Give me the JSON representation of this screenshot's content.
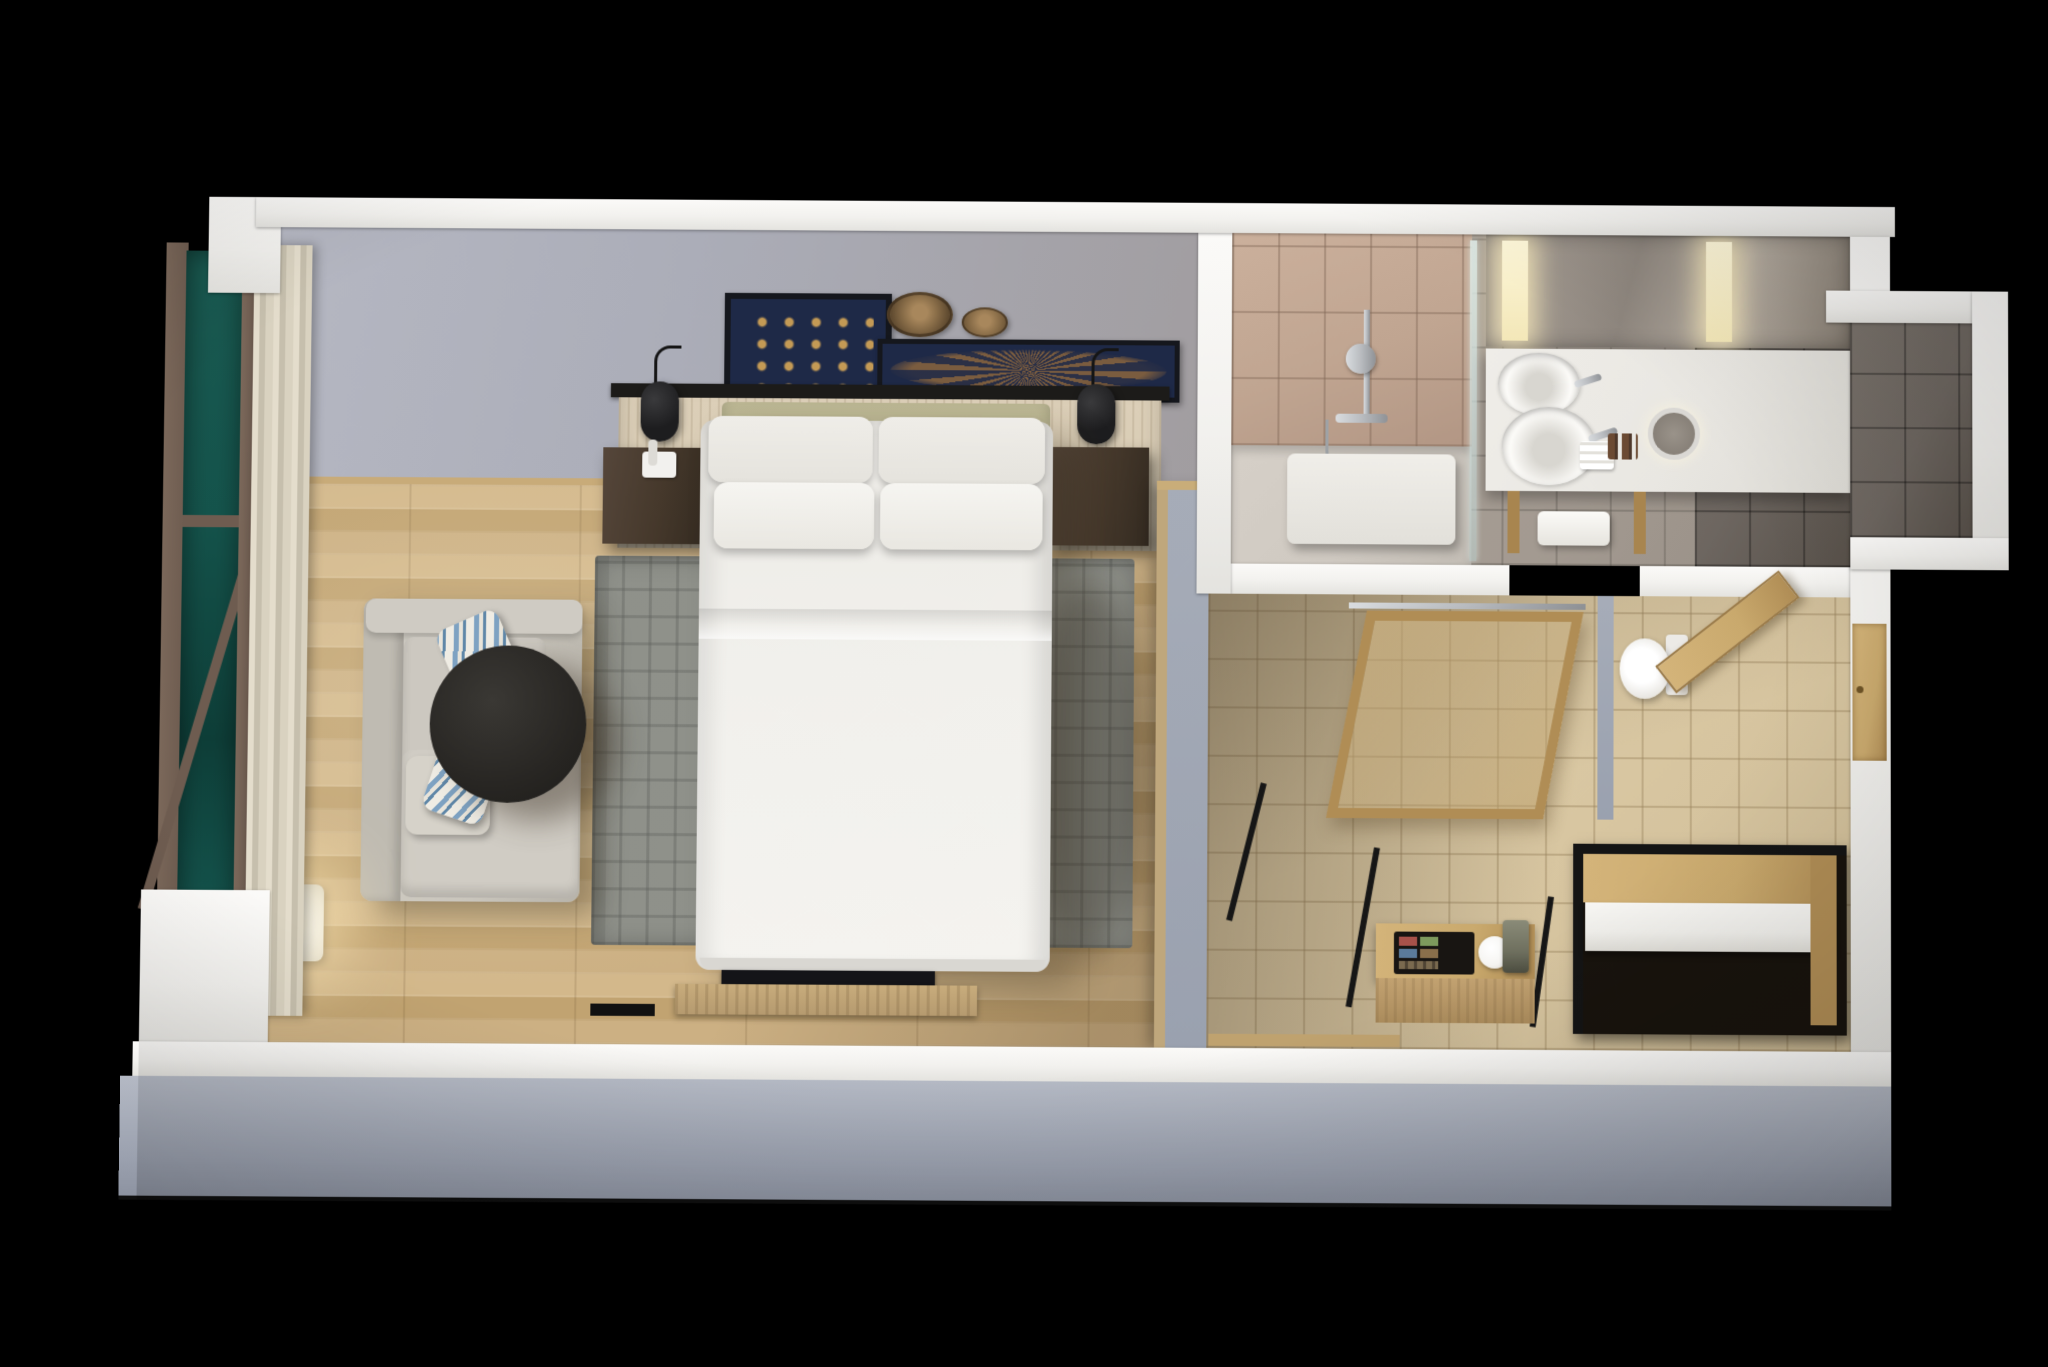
{
  "scene": {
    "type": "3d-floor-plan-render",
    "subject": "hotel-guest-room-studio",
    "view": "isometric-top-down-cutaway",
    "visible_text": []
  },
  "palette": {
    "bg": "#000000",
    "wall": "#f2f1ee",
    "wall-face": "#9aa1af",
    "interior-wall": "#abadb8",
    "wood-a": "#ccb083",
    "wood-b": "#c1a371",
    "rug": "#8b8d86",
    "linen": "#f1f0ec",
    "linen-dim": "#e5e3dd",
    "hb-wood": "#d5c9b1",
    "hb-olive": "#b2ad88",
    "rail": "#1c1b19",
    "nightstand": "#45382b",
    "navy": "#1e2947",
    "gold": "#c49a55",
    "frame-dark": "#15171d",
    "basket": "#8a6e49",
    "sofa": "#c9c5bc",
    "stripe": "#7ea2c2",
    "table": "#282623",
    "curtain": "#d9d2c0",
    "window-teal": "#15544c",
    "window-frame": "#6e5c50",
    "tile-shower": "#c0a591",
    "tile-bath": "#a39a91",
    "tile-dark": "#6d6660",
    "tile-entry": "#d8c6a1",
    "counter": "#e9e7e2",
    "chrome": "#b9bcc0",
    "door-wood": "#c9a96d",
    "closet-frame": "#141414",
    "shelf": "#efeeea",
    "machine": "#6e6f5e",
    "tray": "#181512",
    "chip-red": "#a8524a",
    "chip-green": "#7d9a5d",
    "chip-blue": "#5b7b9b",
    "chip-brown": "#8a6f4b",
    "kettle": "#f5f4f1",
    "lamp-glow": "#ffe9b8"
  },
  "rooms": {
    "bedroom": {
      "floor": "wood-plank",
      "objects": [
        "king-bed",
        "pillows-x4",
        "olive-headboard",
        "headboard-wood-panel",
        "pendant-reading-lamp-left",
        "pendant-reading-lamp-right",
        "nightstand-left",
        "nightstand-right",
        "telephone",
        "framed-shell-art",
        "woven-basket-large",
        "woven-basket-small",
        "framed-branch-art",
        "plaid-area-rug",
        "sofa-with-chaise",
        "striped-throw-pillows-x2",
        "round-black-coffee-table",
        "floor-lamp-lit",
        "tv-media-console",
        "window-with-teal-glass",
        "cream-curtains"
      ]
    },
    "bathroom": {
      "floor": "stone-tile",
      "objects": [
        "walk-in-shower",
        "hand-shower-on-rail",
        "glass-screen",
        "bath-bench",
        "double-vanity-counter",
        "vessel-sink-x2",
        "backlit-mirror",
        "magnifying-mirror",
        "towels",
        "amenity-bottles"
      ]
    },
    "entry": {
      "floor": "beige-tile",
      "objects": [
        "sliding-wood-glass-door",
        "toilet",
        "toilet-door-open",
        "entry-door",
        "minibar-console",
        "tea-tray",
        "kettle",
        "coffee-machine",
        "open-closet-with-shelf"
      ]
    }
  }
}
